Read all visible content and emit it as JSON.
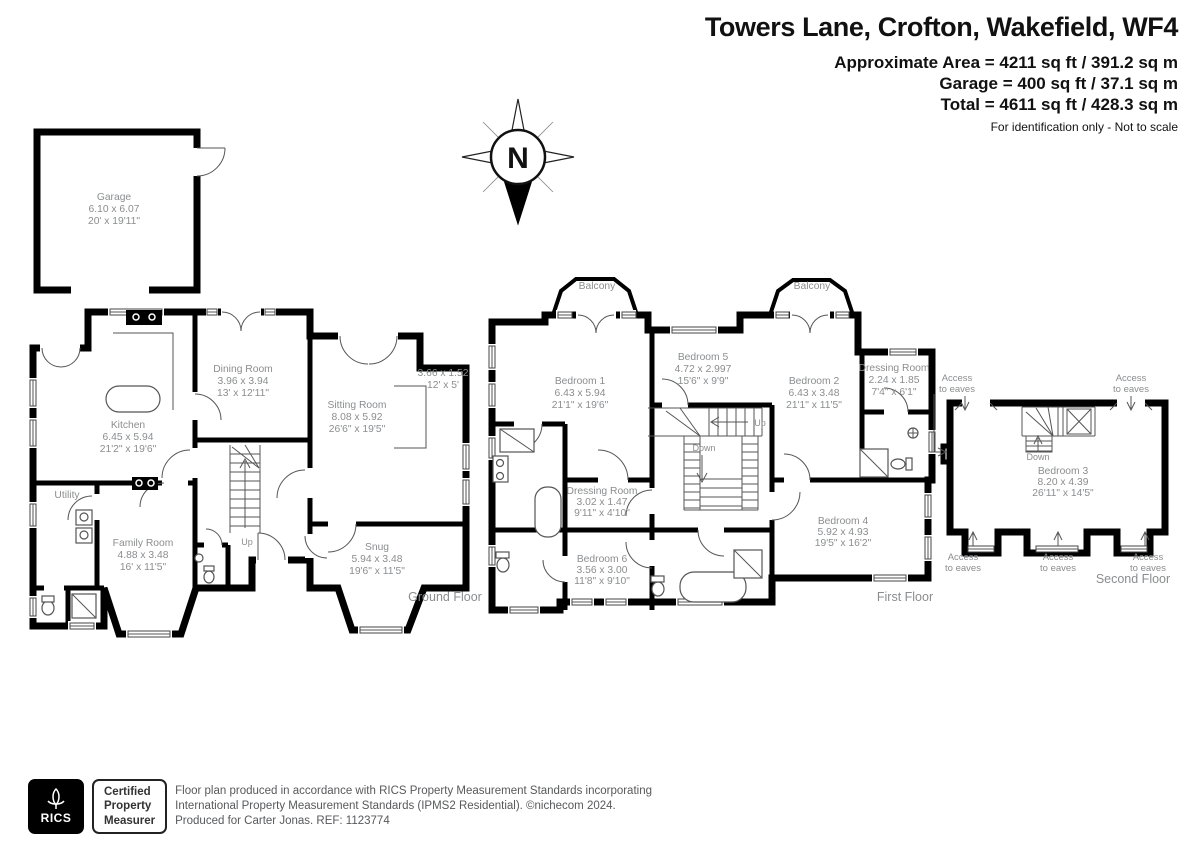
{
  "header": {
    "title": "Towers Lane, Crofton, Wakefield, WF4",
    "approx_area": "Approximate Area = 4211 sq ft / 391.2 sq m",
    "garage_area": "Garage = 400 sq ft / 37.1 sq m",
    "total_area": "Total = 4611 sq ft / 428.3 sq m",
    "disclaimer": "For identification only - Not to scale"
  },
  "compass": {
    "north_label": "N"
  },
  "garage_plan": {
    "room": {
      "name": "Garage",
      "metric": "6.10 x 6.07",
      "imperial": "20' x 19'11\""
    }
  },
  "ground_floor": {
    "floor_label": "Ground Floor",
    "stairs_up": "Up",
    "kitchen": {
      "name": "Kitchen",
      "metric": "6.45 x 5.94",
      "imperial": "21'2\" x 19'6\""
    },
    "dining_room": {
      "name": "Dining Room",
      "metric": "3.96 x 3.94",
      "imperial": "13' x 12'11\""
    },
    "sitting_room": {
      "name": "Sitting Room",
      "metric": "8.08 x 5.92",
      "imperial": "26'6\" x 19'5\""
    },
    "sitting_bay": {
      "metric": "3.66 x 1.52",
      "imperial": "12' x 5'"
    },
    "utility": {
      "name": "Utility"
    },
    "family_room": {
      "name": "Family Room",
      "metric": "4.88 x 3.48",
      "imperial": "16' x 11'5\""
    },
    "snug": {
      "name": "Snug",
      "metric": "5.94 x 3.48",
      "imperial": "19'6\" x 11'5\""
    }
  },
  "first_floor": {
    "floor_label": "First Floor",
    "stairs_up": "Up",
    "stairs_down": "Down",
    "balcony": "Balcony",
    "bedroom1": {
      "name": "Bedroom 1",
      "metric": "6.43 x 5.94",
      "imperial": "21'1\" x 19'6\""
    },
    "bedroom5": {
      "name": "Bedroom 5",
      "metric": "4.72 x 2.997",
      "imperial": "15'6\" x 9'9\""
    },
    "bedroom2": {
      "name": "Bedroom 2",
      "metric": "6.43 x 3.48",
      "imperial": "21'1\" x 11'5\""
    },
    "dressing_room_2": {
      "name": "Dressing Room",
      "metric": "2.24 x 1.85",
      "imperial": "7'4\" x 6'1\""
    },
    "dressing_room_1": {
      "name": "Dressing Room",
      "metric": "3.02 x 1.47",
      "imperial": "9'11\" x 4'10\""
    },
    "bedroom6": {
      "name": "Bedroom 6",
      "metric": "3.56 x 3.00",
      "imperial": "11'8\" x 9'10\""
    },
    "bedroom4": {
      "name": "Bedroom 4",
      "metric": "5.92 x 4.93",
      "imperial": "19'5\" x 16'2\""
    }
  },
  "second_floor": {
    "floor_label": "Second Floor",
    "stairs_down": "Down",
    "eaves_line1": "Access",
    "eaves_line2": "to eaves",
    "bedroom3": {
      "name": "Bedroom 3",
      "metric": "8.20 x 4.39",
      "imperial": "26'11\" x 14'5\""
    }
  },
  "footer": {
    "rics_label": "RICS",
    "cert_line1": "Certified",
    "cert_line2": "Property",
    "cert_line3": "Measurer",
    "line1": "Floor plan produced in accordance with RICS Property Measurement Standards incorporating",
    "line2": "International Property Measurement Standards (IPMS2 Residential).  ©nichecom 2024.",
    "line3": "Produced for Carter Jonas.   REF:  1123774"
  }
}
